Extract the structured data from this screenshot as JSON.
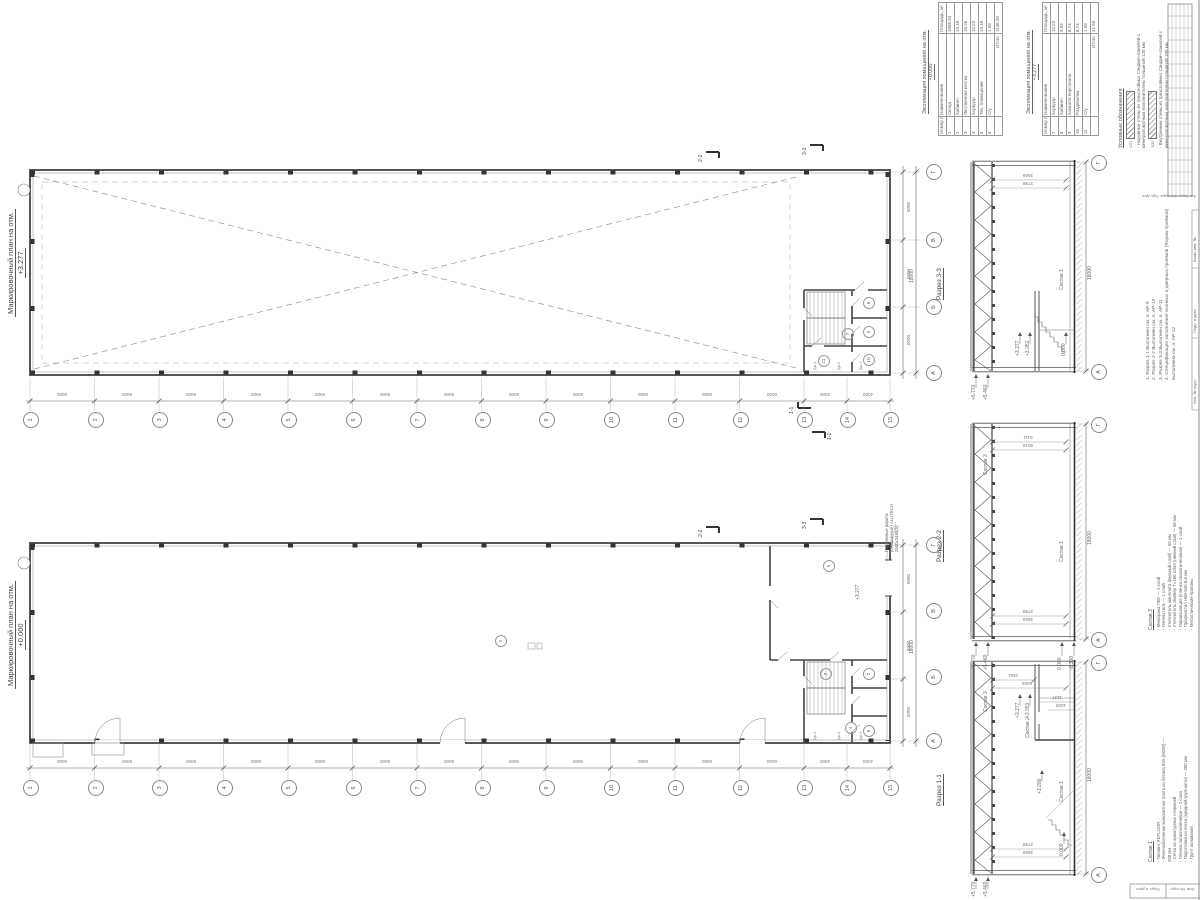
{
  "sheet": {
    "plans": [
      {
        "title": "Маркировочный план на отм.",
        "elev": "+3.277"
      },
      {
        "title": "Маркировочный план на отм.",
        "elev": "+0.000"
      }
    ],
    "grid": {
      "cols": [
        "1",
        "2",
        "3",
        "4",
        "5",
        "6",
        "7",
        "8",
        "9",
        "10",
        "11",
        "12",
        "13",
        "14",
        "15"
      ],
      "col_dims": [
        "6000",
        "6000",
        "6000",
        "6000",
        "6000",
        "6000",
        "6000",
        "6000",
        "6000",
        "6000",
        "6000",
        "6000",
        "4000",
        "4000"
      ],
      "rows": [
        "Г",
        "В",
        "Б",
        "А"
      ],
      "row_dims": [
        "6000",
        "6000",
        "6000"
      ],
      "row_total": "18000"
    }
  },
  "tables": [
    {
      "title": "Экспликация помещений на отм.",
      "title_elev": "+0.000",
      "headers": [
        "Номер помещ.",
        "Наименование",
        "Площадь, м²"
      ],
      "rows": [
        [
          "1",
          "Склад",
          "1088.94"
        ],
        [
          "2",
          "Кабинет",
          "13.49"
        ],
        [
          "3",
          "Лестничная клетка",
          "16.26"
        ],
        [
          "4",
          "Коридор",
          "12.52"
        ],
        [
          "5",
          "Тех. помещение",
          "13.49"
        ],
        [
          "6",
          "С/у",
          "1.58"
        ]
      ],
      "total_label": "Итого:",
      "total_value": "1146.28"
    },
    {
      "title": "Экспликация помещений на отм.",
      "title_elev": "+3.277",
      "headers": [
        "Номер помещ.",
        "Наименование",
        "Площадь, м²"
      ],
      "rows": [
        [
          "7",
          "Коридор",
          "12.52"
        ],
        [
          "8",
          "Кабинет",
          "9.92"
        ],
        [
          "9",
          "Комната персонала",
          "8.74"
        ],
        [
          "10",
          "Раздевалка",
          "8.74"
        ],
        [
          "11",
          "С/у",
          "1.58"
        ]
      ],
      "total_label": "Итого:",
      "total_value": "41.50"
    }
  ],
  "legend": {
    "title": "Условные обозначения",
    "items": [
      {
        "text": "- Наружные стены из трехслойных Сэндвич-панелей с минераловатным наполнителем толщиной 120 мм",
        "dim": "120"
      },
      {
        "text": "- Внутренние стены из трехслойных Сэндвич-панелей с минераловатным наполнителем толщиной 100 мм",
        "dim": "100"
      }
    ]
  },
  "notes": {
    "items": [
      "1. Разрез 1-1 Выполнен см. л. АР-9",
      "2. Разрез 2-2 Выполнен см. л. АР-10",
      "3. Разрез 3-3 Выполнен см. л. АР-11",
      "4. Спецификация заполнения оконных и дверных проемов (Форма проемов) выполнена см. л. АР-12"
    ]
  },
  "compositions": {
    "roof": {
      "label": "Состав 3",
      "layers": [
        "- Мембрана ПВХ — 1 слой",
        "- Геотекстиль — 1 слой",
        "- Утеплитель минплита (верхний слой) — 50 мм",
        "- Утеплитель ЭкоВер Т=100 кг/м3 (нижний слой) — 50 мм",
        "- Пароизоляция (пленка полиэтиленовая) — 1 слой",
        "- Профнастил Н60-845-0,8 мм",
        "- Металлические прогоны"
      ]
    },
    "floor": {
      "label": "Состав 1",
      "layers": [
        "- Топпинг REFLOOR",
        "- Железобетонная монолитная плита из бетона В15 (М200) — 200 мм",
        "- Сетка из арматурных стержней",
        "- Пленка полиэтиленовая — 2 слоя",
        "- Подготовка из песка (средней крупности) — 200 мм",
        "- Грунт основания"
      ]
    },
    "mezzanine_label": "Состав 2"
  },
  "sections": [
    {
      "title": "Разрез 3-3",
      "dims": [
        "3569",
        "2798"
      ],
      "elevs": [
        "+5.770",
        "+5.460",
        "+3.277",
        "+3.051",
        "0.000"
      ],
      "total_dim": "18000",
      "bubbles": [
        "Г",
        "А"
      ]
    },
    {
      "title": "Разрез 2-2",
      "dims": [
        "6111",
        "9018",
        "2798",
        "3569"
      ],
      "elevs": [
        "+5.770",
        "+5.460",
        "0.000",
        "-0.300"
      ],
      "total_dim": "18000",
      "bubbles": [
        "Г",
        "А"
      ]
    },
    {
      "title": "Разрез 1-1",
      "dims": [
        "2561",
        "6655",
        "1137",
        "1508",
        "2798",
        "3569"
      ],
      "elevs": [
        "+5.770",
        "+5.460",
        "+3.277",
        "+3.051",
        "+1.200",
        "0.000"
      ],
      "total_dim": "18000",
      "bubbles": [
        "Г",
        "А"
      ]
    }
  ],
  "annotations": {
    "door_note": "Подъемные ворота (секционные) ALUTECH 2500х3480(h)",
    "plan2_elev_tag": "+3.277",
    "section_marks": [
      "1-1",
      "2-2",
      "3-3"
    ],
    "room_tags_plan1": [
      "7",
      "8",
      "9",
      "10",
      "11"
    ],
    "room_tags_plan2": [
      "1",
      "2",
      "3",
      "4",
      "5",
      "6"
    ],
    "door_tags_plan1": [
      "Дв-4",
      "Дв-5",
      "Дв-1"
    ],
    "door_tags_plan2": [
      "Дв-1",
      "Дв-2",
      "Дв-3"
    ]
  },
  "title_block": {
    "revision_header": "Изм. Кол.уч. Лист №док. Подп. Дата",
    "side_labels": [
      "Взам. инв. №",
      "Подп. и дата",
      "Инв. № подл."
    ],
    "bottom_cells": [
      "Подп. и дата",
      "Инв. № подл."
    ]
  }
}
